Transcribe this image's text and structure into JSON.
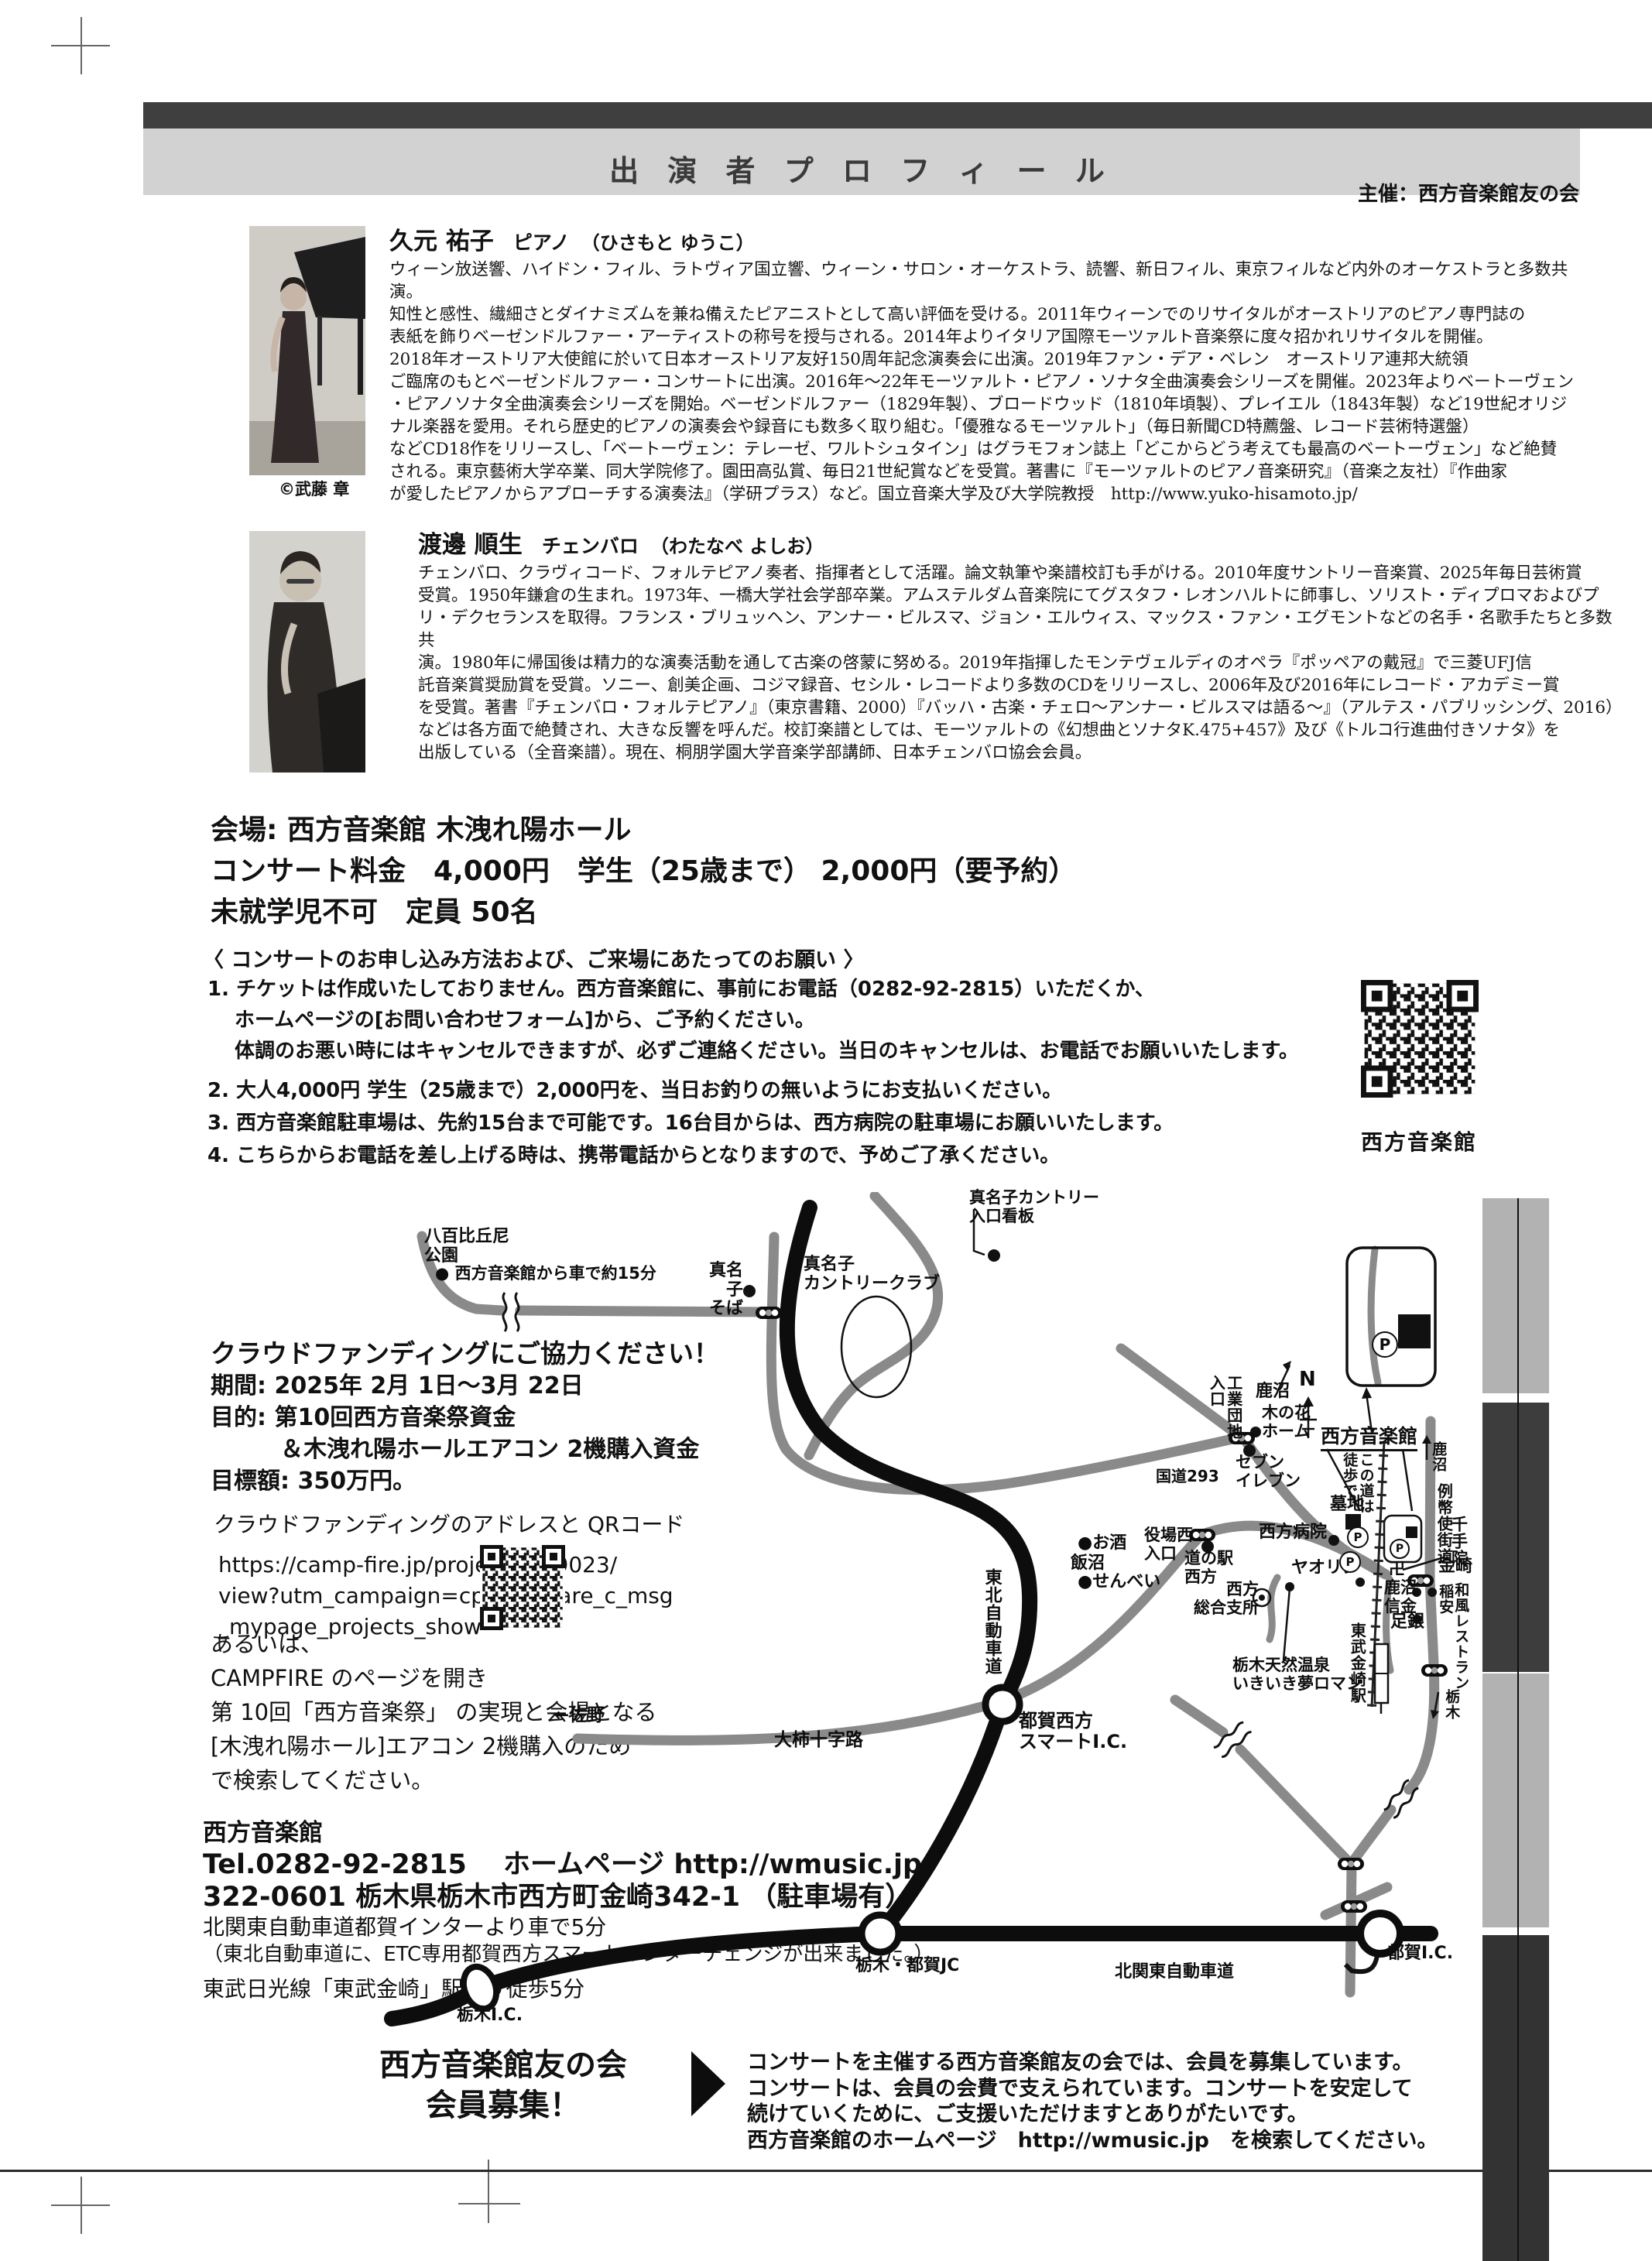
{
  "header": {
    "title": "出 演 者 プ ロ フ ィ ー ル",
    "organizer": "主催：西方音楽館友の会"
  },
  "profiles": [
    {
      "name": "久元 祐子",
      "role": "ピアノ",
      "kana": "（ひさもと ゆうこ）",
      "credit": "©武藤 章",
      "bio": "ウィーン放送響、ハイドン・フィル、ラトヴィア国立響、ウィーン・サロン・オーケストラ、読響、新日フィル、東京フィルなど内外のオーケストラと多数共演。\n知性と感性、繊細さとダイナミズムを兼ね備えたピアニストとして高い評価を受ける。2011年ウィーンでのリサイタルがオーストリアのピアノ専門誌の\n表紙を飾りベーゼンドルファー・アーティストの称号を授与される。2014年よりイタリア国際モーツァルト音楽祭に度々招かれリサイタルを開催。\n2018年オーストリア大使館に於いて日本オーストリア友好150周年記念演奏会に出演。2019年ファン・デア・ベレン　オーストリア連邦大統領\nご臨席のもとベーゼンドルファー・コンサートに出演。2016年～22年モーツァルト・ピアノ・ソナタ全曲演奏会シリーズを開催。2023年よりベートーヴェン\n・ピアノソナタ全曲演奏会シリーズを開始。ベーゼンドルファー（1829年製）、ブロードウッド（1810年頃製）、プレイエル（1843年製）など19世紀オリジ\nナル楽器を愛用。それら歴史的ピアノの演奏会や録音にも数多く取り組む。「優雅なるモーツァルト」（毎日新聞CD特薦盤、レコード芸術特選盤）\nなどCD18作をリリースし、「ベートーヴェン：テレーゼ、ワルトシュタイン」はグラモフォン誌上「どこからどう考えても最高のベートーヴェン」など絶賛\nされる。東京藝術大学卒業、同大学院修了。園田高弘賞、毎日21世紀賞などを受賞。著書に『モーツァルトのピアノ音楽研究』（音楽之友社）『作曲家\nが愛したピアノからアプローチする演奏法』（学研プラス）など。国立音楽大学及び大学院教授　http://www.yuko-hisamoto.jp/"
    },
    {
      "name": "渡邊 順生",
      "role": "チェンバロ",
      "kana": "（わたなべ よしお）",
      "bio": "チェンバロ、クラヴィコード、フォルテピアノ奏者、指揮者として活躍。論文執筆や楽譜校訂も手がける。2010年度サントリー音楽賞、2025年毎日芸術賞\n受賞。1950年鎌倉の生まれ。1973年、一橋大学社会学部卒業。アムステルダム音楽院にてグスタフ・レオンハルトに師事し、ソリスト・ディプロマおよびプ\nリ・デクセランスを取得。フランス・ブリュッヘン、アンナー・ビルスマ、ジョン・エルウィス、マックス・ファン・エグモントなどの名手・名歌手たちと多数共\n演。1980年に帰国後は精力的な演奏活動を通して古楽の啓蒙に努める。2019年指揮したモンテヴェルディのオペラ『ポッペアの戴冠』で三菱UFJ信\n託音楽賞奨励賞を受賞。ソニー、創美企画、コジマ録音、セシル・レコードより多数のCDをリリースし、2006年及び2016年にレコード・アカデミー賞\nを受賞。著書『チェンバロ・フォルテピアノ』（東京書籍、2000）『バッハ・古楽・チェロ～アンナー・ビルスマは語る～』（アルテス・パブリッシング、2016）\nなどは各方面で絶賛され、大きな反響を呼んだ。校訂楽譜としては、モーツァルトの《幻想曲とソナタK.475+457》及び《トルコ行進曲付きソナタ》を\n出版している（全音楽譜）。現在、桐朋学園大学音楽学部講師、日本チェンバロ協会会員。"
    }
  ],
  "venue": {
    "text": "会場: 西方音楽館 木洩れ陽ホール\nコンサート料金　4,000円　学生（25歳まで） 2,000円（要予約）\n未就学児不可　定員 50名"
  },
  "notice": {
    "heading": "〈 コンサートのお申し込み方法および、ご来場にあたってのお願い 〉",
    "item1": "1. チケットは作成いたしておりません。西方音楽館に、事前にお電話（0282-92-2815）いただくか、\n　 ホームページの[お問い合わせフォーム]から、ご予約ください。\n　 体調のお悪い時にはキャンセルできますが、必ずご連絡ください。当日のキャンセルは、お電話でお願いいたします。",
    "item2": "2. 大人4,000円 学生（25歳まで）2,000円を、当日お釣りの無いようにお支払いください。",
    "item3": "3. 西方音楽館駐車場は、先約15台まで可能です。16台目からは、西方病院の駐車場にお願いいたします。",
    "item4": "4. こちらからお電話を差し上げる時は、携帯電話からとなりますので、予めご了承ください。",
    "qr_label": "西方音楽館"
  },
  "crowdfunding": {
    "title": "クラウドファンディングにご協力ください！",
    "details": "期間: 2025年 2月 1日～3月 22日\n目的: 第10回西方音楽祭資金\n　　　＆木洩れ陽ホールエアコン 2機購入資金\n目標額: 350万円。",
    "qr_heading": "クラウドファンディングのアドレスと QRコード",
    "url": "https://camp-fire.jp/projects/819023/\nview?utm_campaign=cp_po_share_c_msg\n_mypage_projects_show",
    "alt": "あるいは、\nCAMPFIRE のページを開き\n第 10回「西方音楽祭」 の実現と会場となる\n[木洩れ陽ホール]エアコン 2機購入のため\nで検索してください。"
  },
  "contact": {
    "name": "西方音楽館",
    "tel": "Tel.0282-92-2815　 ホームページ  http://wmusic.jp",
    "address": "322-0601 栃木県栃木市西方町金崎342-1 （駐車場有）",
    "access_car": "北関東自動車道都賀インターより車で5分",
    "access_car_note": "（東北自動車道に、ETC専用都賀西方スマートインターチェンジが出来ました。）",
    "access_train": "東武日光線「東武金崎」駅より徒歩5分"
  },
  "recruit": {
    "title": "西方音楽館友の会\n会員募集！",
    "body": "コンサートを主催する西方音楽館友の会では、会員を募集しています。\nコンサートは、会員の会費で支えられています。コンサートを安定して\n続けていくために、ご支援いただけますとありがたいです。\n西方音楽館のホームページ　http://wmusic.jp　を検索してください。"
  },
  "icons": {
    "parking": "P",
    "temple": "卍",
    "north": "N"
  },
  "map": {
    "labels": [
      {
        "text": "八百比丘尼\n公園"
      },
      {
        "text": "●  西方音楽館から車で約15分"
      },
      {
        "text": "真名子\nそば"
      },
      {
        "text": "真名子\nカントリークラブ"
      },
      {
        "text": "真名子カントリー\n入口看板"
      },
      {
        "text": "工業団地\n入口"
      },
      {
        "text": "鹿沼"
      },
      {
        "text": "N"
      },
      {
        "text": "木の花\nホーム"
      },
      {
        "text": "セブン\nイレブン"
      },
      {
        "text": "国道293"
      },
      {
        "text": "西方音楽館"
      },
      {
        "text": "鹿沼"
      },
      {
        "text": "この道は\n徒歩で"
      },
      {
        "text": "例幣使街道"
      },
      {
        "text": "千手院"
      },
      {
        "text": "卍"
      },
      {
        "text": "墓地"
      },
      {
        "text": "西方病院"
      },
      {
        "text": "ヤオリン"
      },
      {
        "text": "金崎"
      },
      {
        "text": "鹿沼\n信金"
      },
      {
        "text": "稲安"
      },
      {
        "text": "和風レストラン"
      },
      {
        "text": "足銀"
      },
      {
        "text": "道の駅\n西方"
      },
      {
        "text": "西方\n総合支所"
      },
      {
        "text": "栃木天然温泉\nいきいき夢ロマン"
      },
      {
        "text": "東武金崎駅"
      },
      {
        "text": "栃木"
      },
      {
        "text": "●お酒"
      },
      {
        "text": "飯沼"
      },
      {
        "text": "●せんべい"
      },
      {
        "text": "役場西\n入口"
      },
      {
        "text": "東北自動車道"
      },
      {
        "text": "都賀西方\nスマートI.C."
      },
      {
        "text": "←佐野"
      },
      {
        "text": "大柿十字路"
      },
      {
        "text": "栃木・都賀JC"
      },
      {
        "text": "北関東自動車道"
      },
      {
        "text": "都賀I.C."
      },
      {
        "text": "栃木I.C."
      }
    ]
  }
}
